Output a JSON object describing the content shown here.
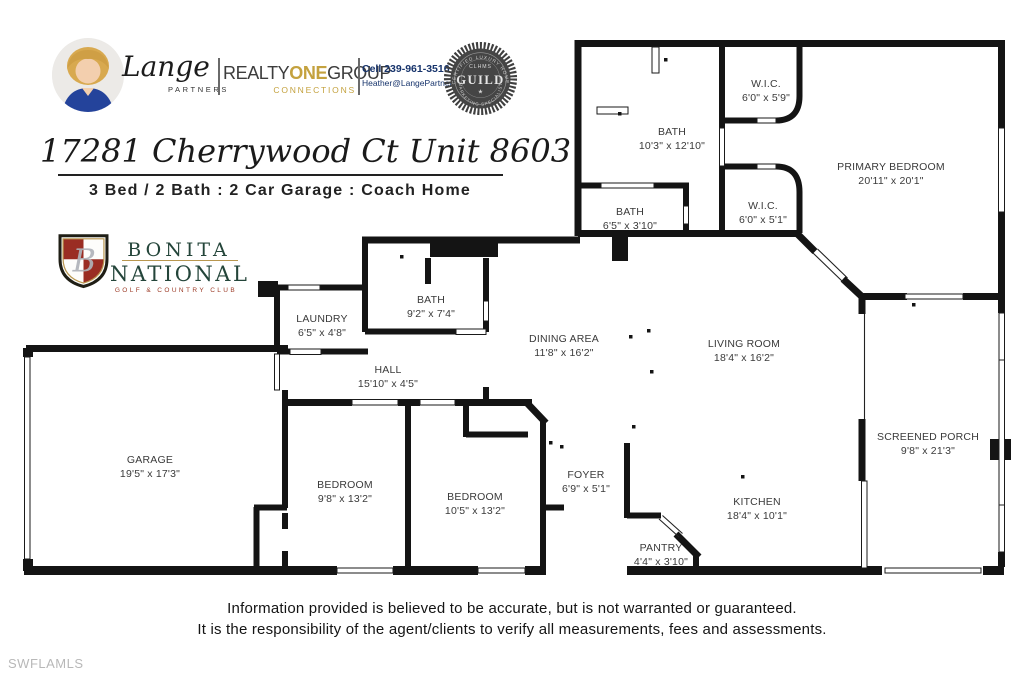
{
  "header": {
    "brand_script": "Lange",
    "brand_sub": "PARTNERS",
    "brokerage": {
      "part1": "REALTY",
      "part2": "ONE",
      "part3": "GROUP",
      "sub": "CONNECTIONS"
    },
    "contact": {
      "phone": "Cell 239-961-3516",
      "email": "Heather@LangePartners.com"
    },
    "seal": {
      "top": "CLHMS",
      "main": "GUILD",
      "star": "★",
      "arc_top": "CERTIFIED LUXURY HOME",
      "arc_bottom": "MARKETING SPECIALIST"
    }
  },
  "listing": {
    "title": "17281 Cherrywood Ct Unit 8603",
    "subtitle": "3 Bed / 2 Bath : 2 Car Garage : Coach Home"
  },
  "club": {
    "monogram": "B",
    "line1": "BONITA",
    "line2": "NATIONAL",
    "line3": "GOLF & COUNTRY CLUB"
  },
  "floorplan": {
    "rooms": [
      {
        "name": "W.I.C.",
        "dims": "6'0\" x 5'9\""
      },
      {
        "name": "BATH",
        "dims": "10'3\" x 12'10\""
      },
      {
        "name": "PRIMARY BEDROOM",
        "dims": "20'11\" x 20'1\""
      },
      {
        "name": "BATH",
        "dims": "6'5\" x 3'10\""
      },
      {
        "name": "W.I.C.",
        "dims": "6'0\" x 5'1\""
      },
      {
        "name": "LAUNDRY",
        "dims": "6'5\" x 4'8\""
      },
      {
        "name": "BATH",
        "dims": "9'2\" x 7'4\""
      },
      {
        "name": "DINING AREA",
        "dims": "11'8\" x 16'2\""
      },
      {
        "name": "LIVING ROOM",
        "dims": "18'4\" x 16'2\""
      },
      {
        "name": "HALL",
        "dims": "15'10\" x 4'5\""
      },
      {
        "name": "GARAGE",
        "dims": "19'5\" x 17'3\""
      },
      {
        "name": "BEDROOM",
        "dims": "9'8\" x 13'2\""
      },
      {
        "name": "BEDROOM",
        "dims": "10'5\" x 13'2\""
      },
      {
        "name": "FOYER",
        "dims": "6'9\" x 5'1\""
      },
      {
        "name": "KITCHEN",
        "dims": "18'4\" x 10'1\""
      },
      {
        "name": "PANTRY",
        "dims": "4'4\" x 3'10\""
      },
      {
        "name": "SCREENED PORCH",
        "dims": "9'8\" x 21'3\""
      }
    ]
  },
  "disclaimer": {
    "line1": "Information provided is believed to be accurate, but is not warranted or guaranteed.",
    "line2": "It is the responsibility of the agent/clients to verify all measurements, fees and assessments."
  },
  "watermark": "SWFLAMLS",
  "colors": {
    "wall": "#141414",
    "gold": "#c4a23f",
    "navy": "#16336b",
    "club_green": "#24453a",
    "club_red": "#9a2d23",
    "seal_gray": "#454545"
  }
}
